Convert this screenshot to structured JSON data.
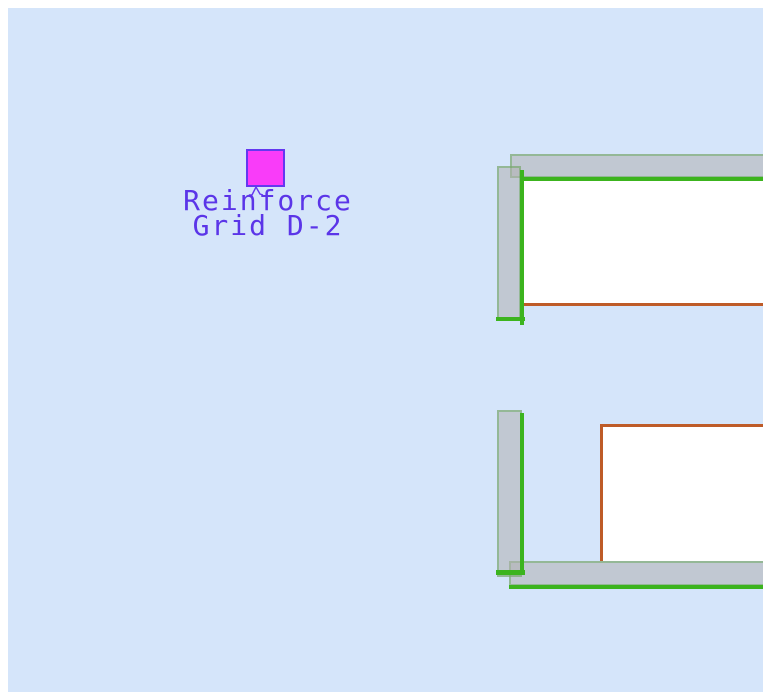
{
  "canvas": {
    "background": "#D5E5FA",
    "margin": "#FFFFFF"
  },
  "palette": {
    "wall_fill": "rgba(176,176,176,0.55)",
    "wall_outline": "rgba(80,160,60,0.40)",
    "beam_green": "#3CB41E",
    "trim_brown": "#BE5B28",
    "room_white": "#FFFFFF"
  },
  "annotation": {
    "marker_fill": "#F93CF9",
    "marker_border": "#6438F0",
    "text_color": "#5B35E8",
    "label": {
      "line1": "Reinforce",
      "line2": "Grid D-2"
    }
  }
}
